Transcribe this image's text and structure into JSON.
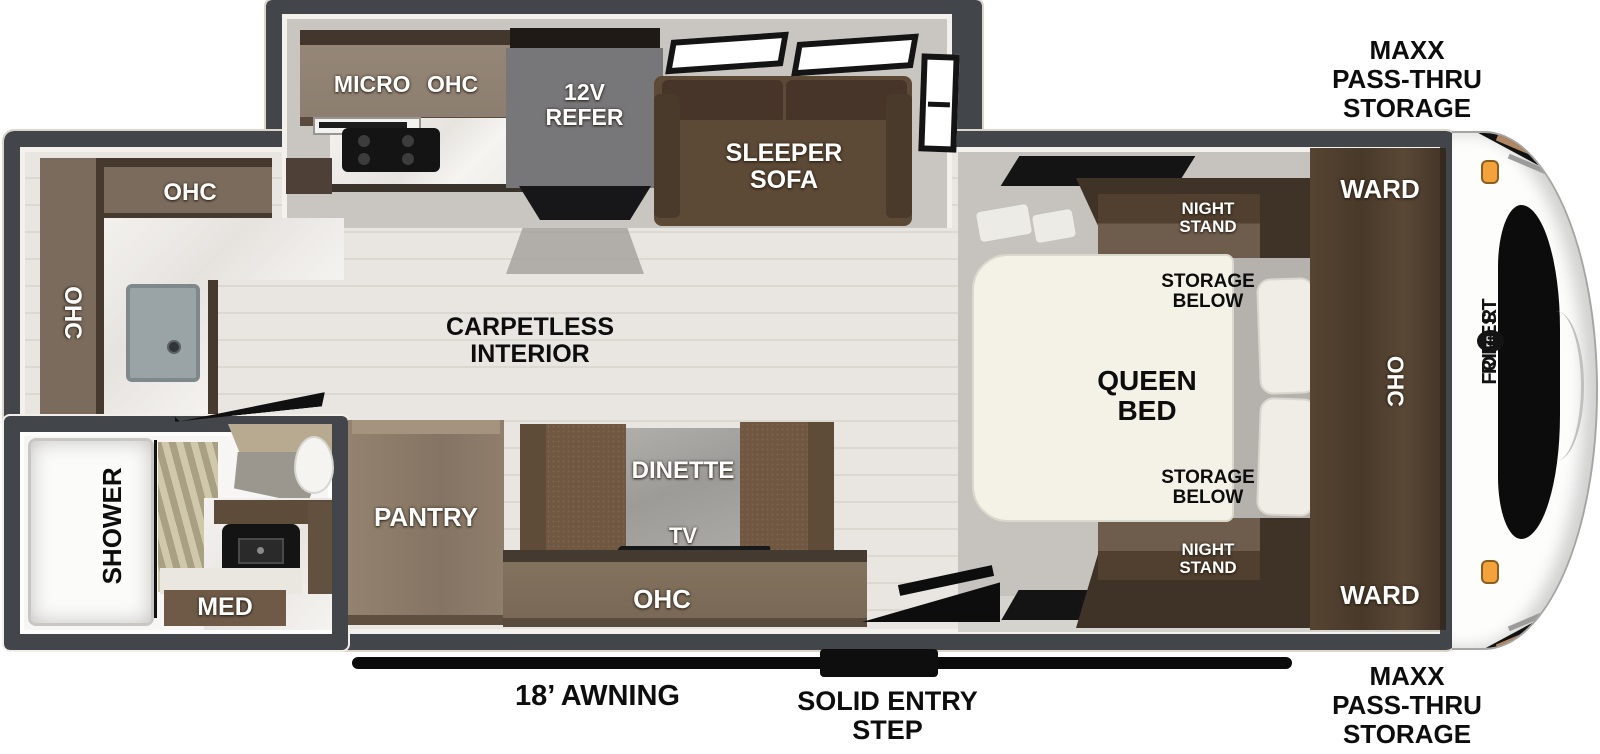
{
  "labels": {
    "maxx_storage_top": "MAXX\nPASS-THRU\nSTORAGE",
    "maxx_storage_bottom": "MAXX\nPASS-THRU\nSTORAGE",
    "micro_ohc": "MICRO OHC",
    "refer": "12V\nREFER",
    "sleeper_sofa": "SLEEPER\nSOFA",
    "rear_ohc_top": "OHC",
    "rear_ohc_left": "OHC",
    "carpetless": "CARPETLESS\nINTERIOR",
    "night_stand_top": "NIGHT\nSTAND",
    "storage_below_top": "STORAGE\nBELOW",
    "queen_bed": "QUEEN\nBED",
    "storage_below_bottom": "STORAGE\nBELOW",
    "night_stand_bottom": "NIGHT\nSTAND",
    "ward_top": "WARD",
    "bedroom_ohc": "OHC",
    "ward_bottom": "WARD",
    "pantry": "PANTRY",
    "dinette": "DINETTE",
    "tv": "TV",
    "ohc_bottom": "OHC",
    "shower": "SHOWER",
    "med": "MED",
    "awning": "18’ AWNING",
    "entry_step": "SOLID ENTRY\nSTEP",
    "brand_front": {
      "left_dash": "—",
      "word1": "FOREST",
      "logo": "FR",
      "word2": "RIVER",
      "right_dash": "—"
    }
  },
  "colors": {
    "wall": "#42464b",
    "cabinet_brown": "#7b6b5c",
    "dark_wood": "#3f3227",
    "slide_floor": "#c9c6c1",
    "plank_floor": "#e9e6e1",
    "marker_light_orange": "#f3a23c",
    "label_white": "#ffffff",
    "label_black": "#0d0d0d"
  }
}
